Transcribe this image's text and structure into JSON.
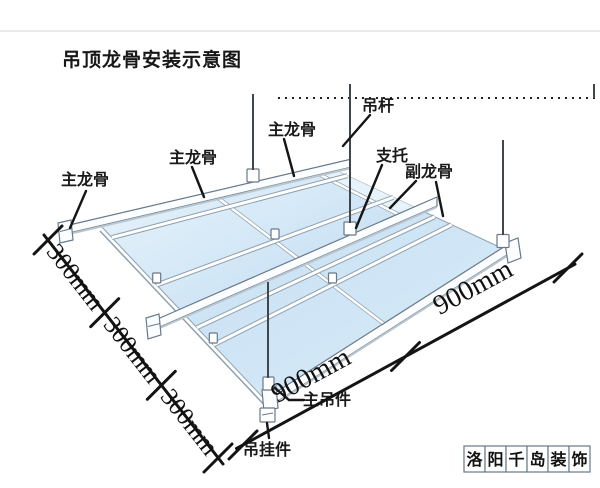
{
  "title": "吊顶龙骨安装示意图",
  "labels": {
    "hanger_rod": "吊杆",
    "main_keel_1": "主龙骨",
    "main_keel_2": "主龙骨",
    "main_keel_3": "主龙骨",
    "support": "支托",
    "secondary_keel": "副龙骨",
    "main_hanger": "主吊件",
    "hanging_piece": "吊挂件"
  },
  "dimensions": {
    "left": [
      "300mm",
      "300mm",
      "300mm"
    ],
    "bottom": [
      "900mm",
      "900mm"
    ]
  },
  "watermark": {
    "text": "洛阳千岛装饰",
    "chars": [
      "洛",
      "阳",
      "千",
      "岛",
      "装",
      "饰"
    ]
  },
  "colors": {
    "panel_light": "#e9f4fb",
    "panel_mid": "#cfe5f5",
    "keel_outline": "#68798a",
    "ink": "#1a1a1a"
  }
}
